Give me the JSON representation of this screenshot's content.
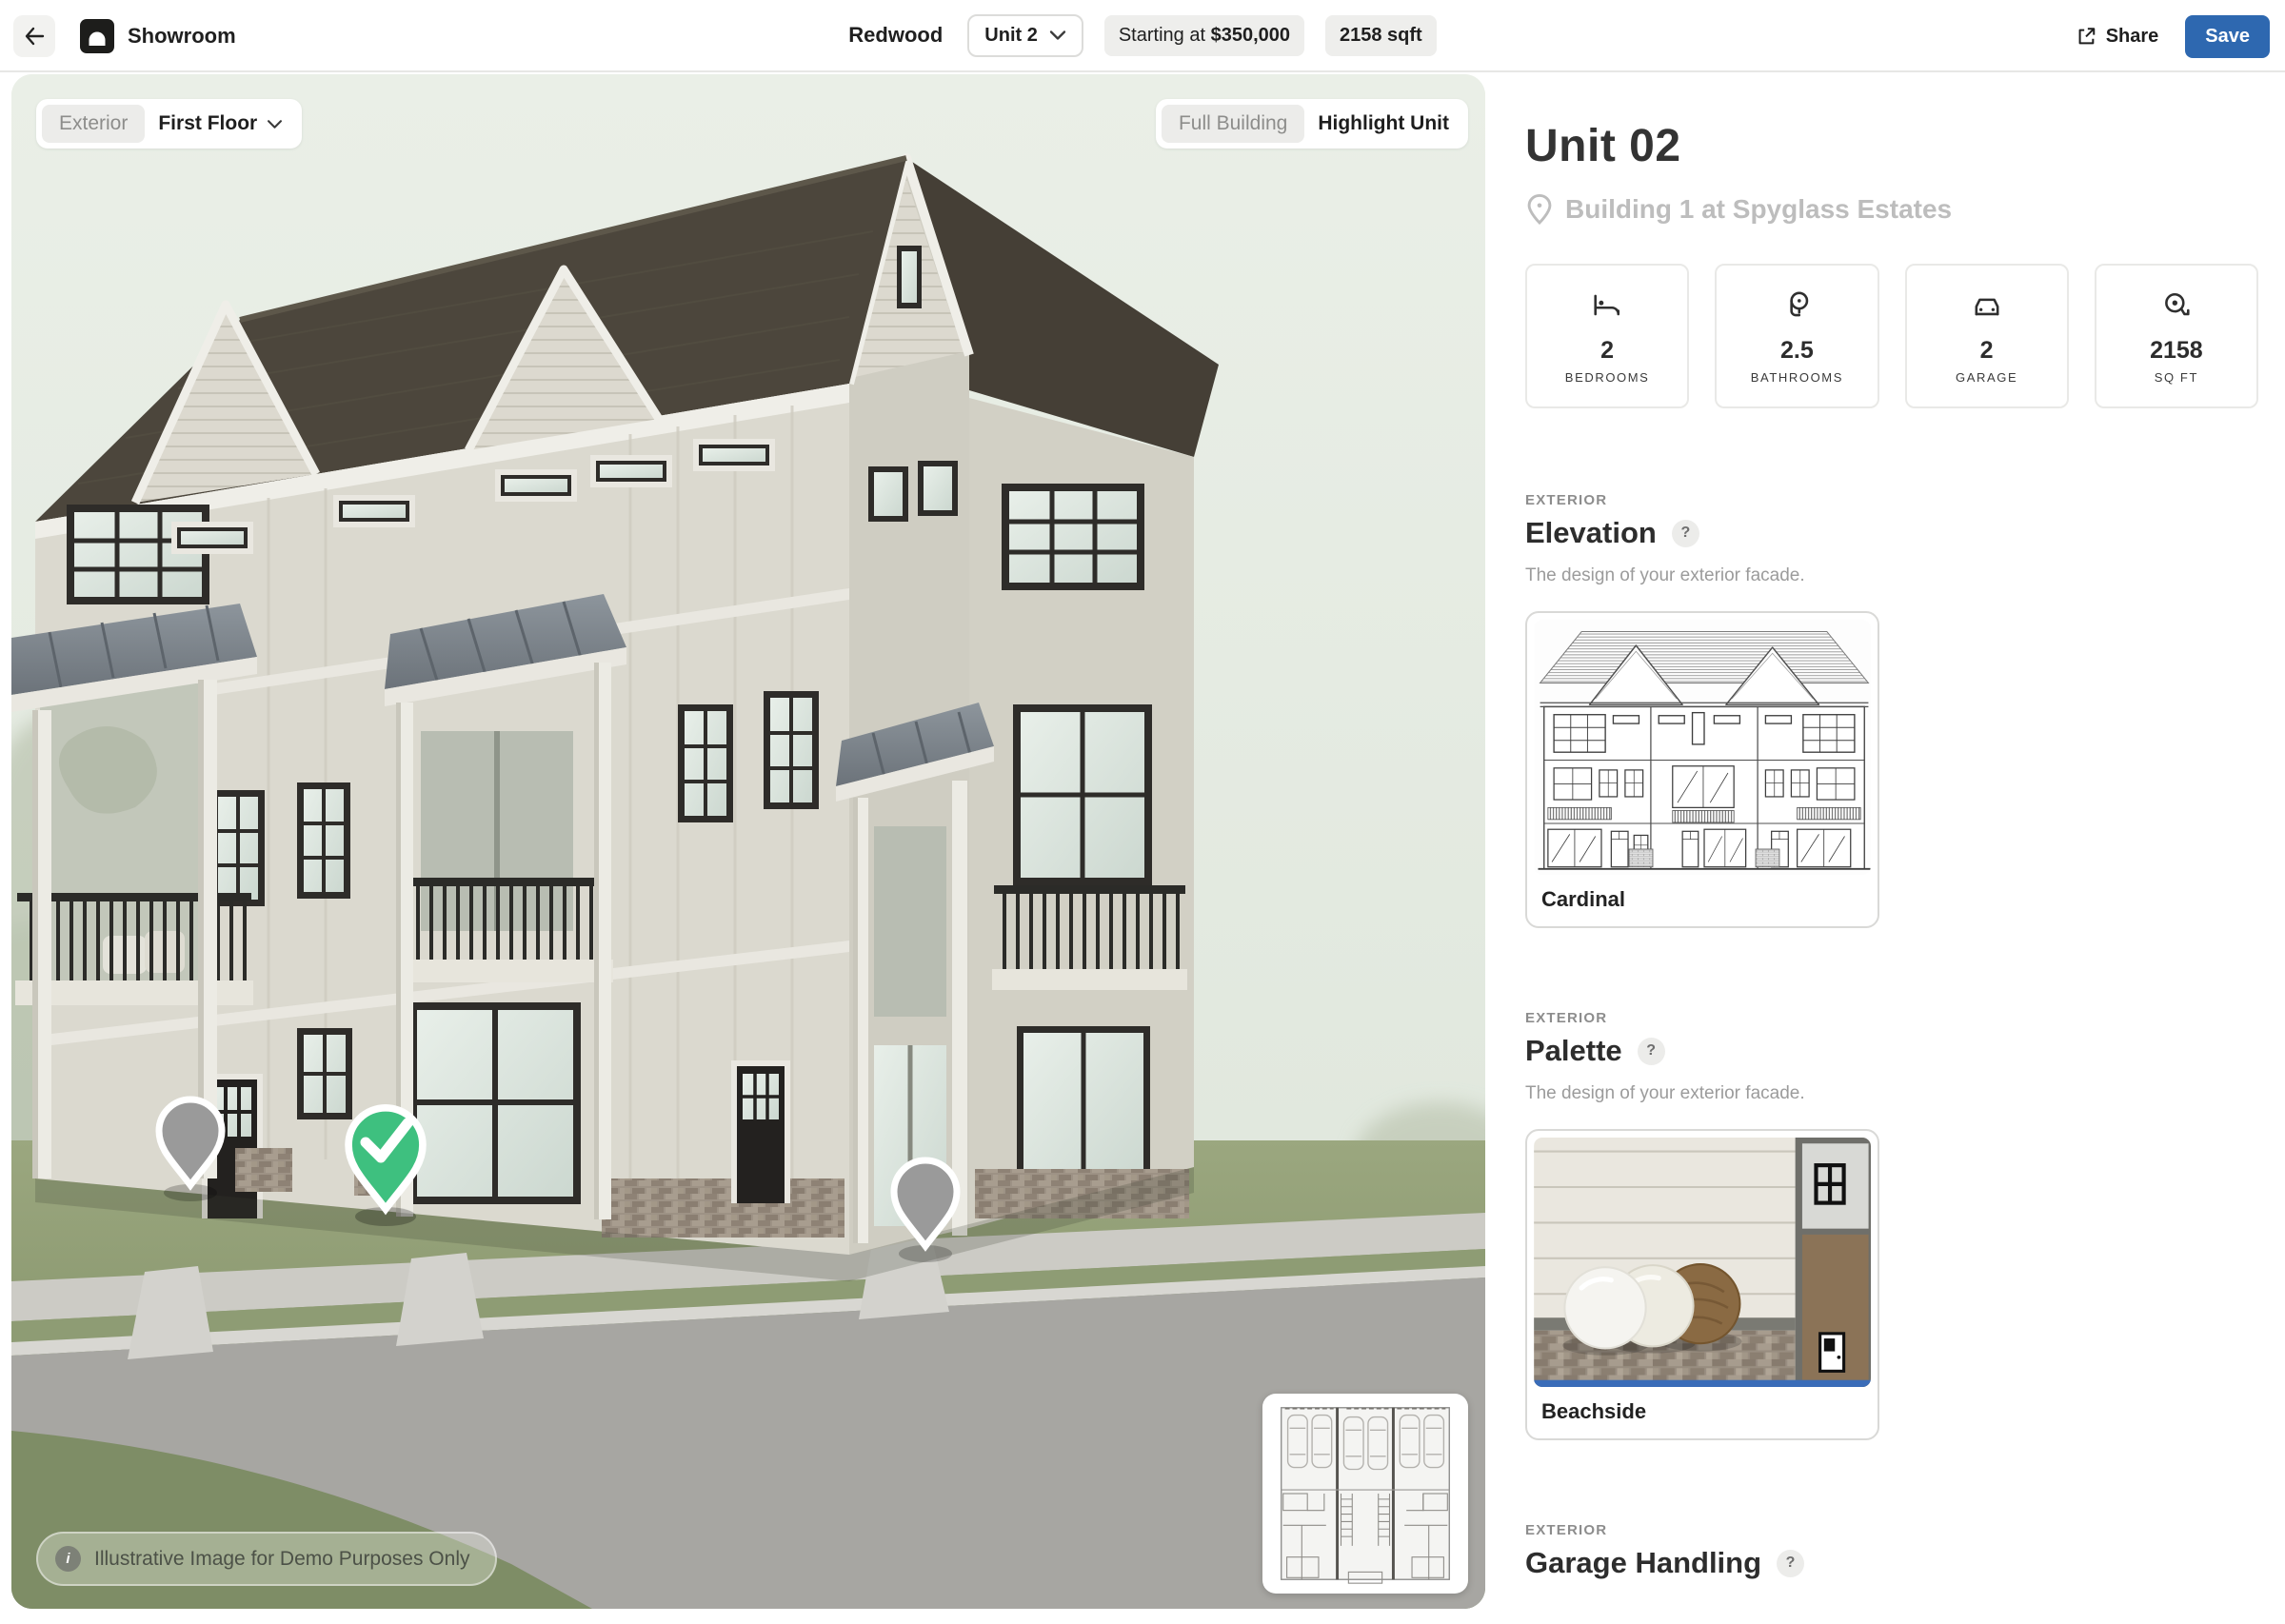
{
  "header": {
    "app_name": "Showroom",
    "plan_name": "Redwood",
    "unit_selector": "Unit 2",
    "price_prefix": "Starting at",
    "price_value": "$350,000",
    "sqft_badge": "2158 sqft",
    "share_label": "Share",
    "save_label": "Save"
  },
  "viewport": {
    "view_selector": {
      "context": "Exterior",
      "floor": "First Floor"
    },
    "mode_toggle": {
      "options": [
        "Full Building",
        "Highlight Unit"
      ],
      "active": "Highlight Unit"
    },
    "disclaimer": "Illustrative Image for Demo Purposes Only",
    "info_icon": "i",
    "pins": [
      {
        "state": "unselected"
      },
      {
        "state": "selected"
      },
      {
        "state": "unselected"
      }
    ]
  },
  "sidebar": {
    "unit_title": "Unit 02",
    "location": "Building 1 at Spyglass Estates",
    "stats": [
      {
        "icon": "bed-icon",
        "value": "2",
        "label": "BEDROOMS"
      },
      {
        "icon": "bath-icon",
        "value": "2.5",
        "label": "BATHROOMS"
      },
      {
        "icon": "car-icon",
        "value": "2",
        "label": "GARAGE"
      },
      {
        "icon": "tape-measure-icon",
        "value": "2158",
        "label": "SQ FT"
      }
    ],
    "sections": [
      {
        "eyebrow": "EXTERIOR",
        "title": "Elevation",
        "help": "?",
        "description": "The design of your exterior facade.",
        "option": {
          "name": "Cardinal",
          "selected": false
        }
      },
      {
        "eyebrow": "EXTERIOR",
        "title": "Palette",
        "help": "?",
        "description": "The design of your exterior facade.",
        "option": {
          "name": "Beachside",
          "selected": true
        }
      },
      {
        "eyebrow": "EXTERIOR",
        "title": "Garage Handling",
        "help": "?"
      }
    ]
  },
  "colors": {
    "save_blue": "#2e68b0",
    "selected_blue": "#3a6cb8",
    "pin_green": "#3ec07f",
    "pin_gray": "#9a9a9a",
    "sky": "#e6ece3",
    "roof": "#4c463c"
  }
}
